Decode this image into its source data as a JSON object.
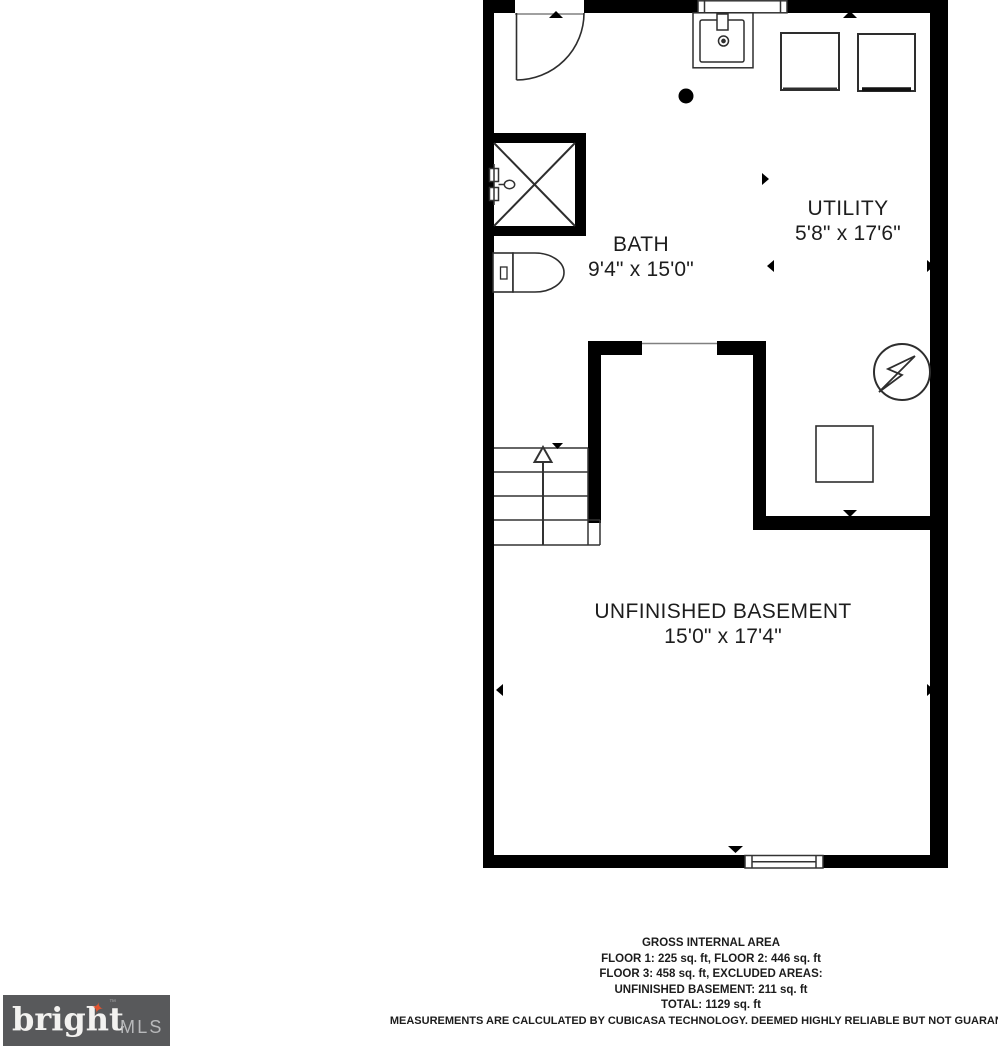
{
  "colors": {
    "wall": "#000000",
    "fixture_line": "#2e2e2e",
    "label_text": "#1d1d1d",
    "logo_bg": "#58595b",
    "logo_brand": "#f3f2f0",
    "logo_mls": "#b8b9bb",
    "logo_star": "#e0532f"
  },
  "plan": {
    "rooms": [
      {
        "name": "BATH",
        "dims": "9'4\" x 15'0\""
      },
      {
        "name": "UTILITY",
        "dims": "5'8\" x 17'6\""
      },
      {
        "name": "UNFINISHED BASEMENT",
        "dims": "15'0\" x 17'4\""
      }
    ],
    "symbols": [
      "door-swing-icon",
      "sink-icon",
      "washer-icon",
      "dryer-icon",
      "floor-drain-icon",
      "shower-icon",
      "shower-valve-icon",
      "toilet-icon",
      "stairs-up-icon",
      "water-heater-icon",
      "furnace-icon",
      "window-icon"
    ]
  },
  "footer": {
    "title": "GROSS INTERNAL AREA",
    "line_floor12": "FLOOR 1: 225 sq. ft, FLOOR 2: 446 sq. ft",
    "line_floor3": "FLOOR 3: 458 sq. ft, EXCLUDED AREAS:",
    "line_basement": "UNFINISHED BASEMENT: 211 sq. ft",
    "line_total": "TOTAL: 1129 sq. ft",
    "disclaimer": "MEASUREMENTS ARE CALCULATED BY CUBICASA TECHNOLOGY. DEEMED HIGHLY RELIABLE BUT NOT GUARANTEED"
  },
  "logo": {
    "brand": "bright",
    "trademark": "™",
    "suffix": "MLS",
    "star_glyph": "✦"
  }
}
